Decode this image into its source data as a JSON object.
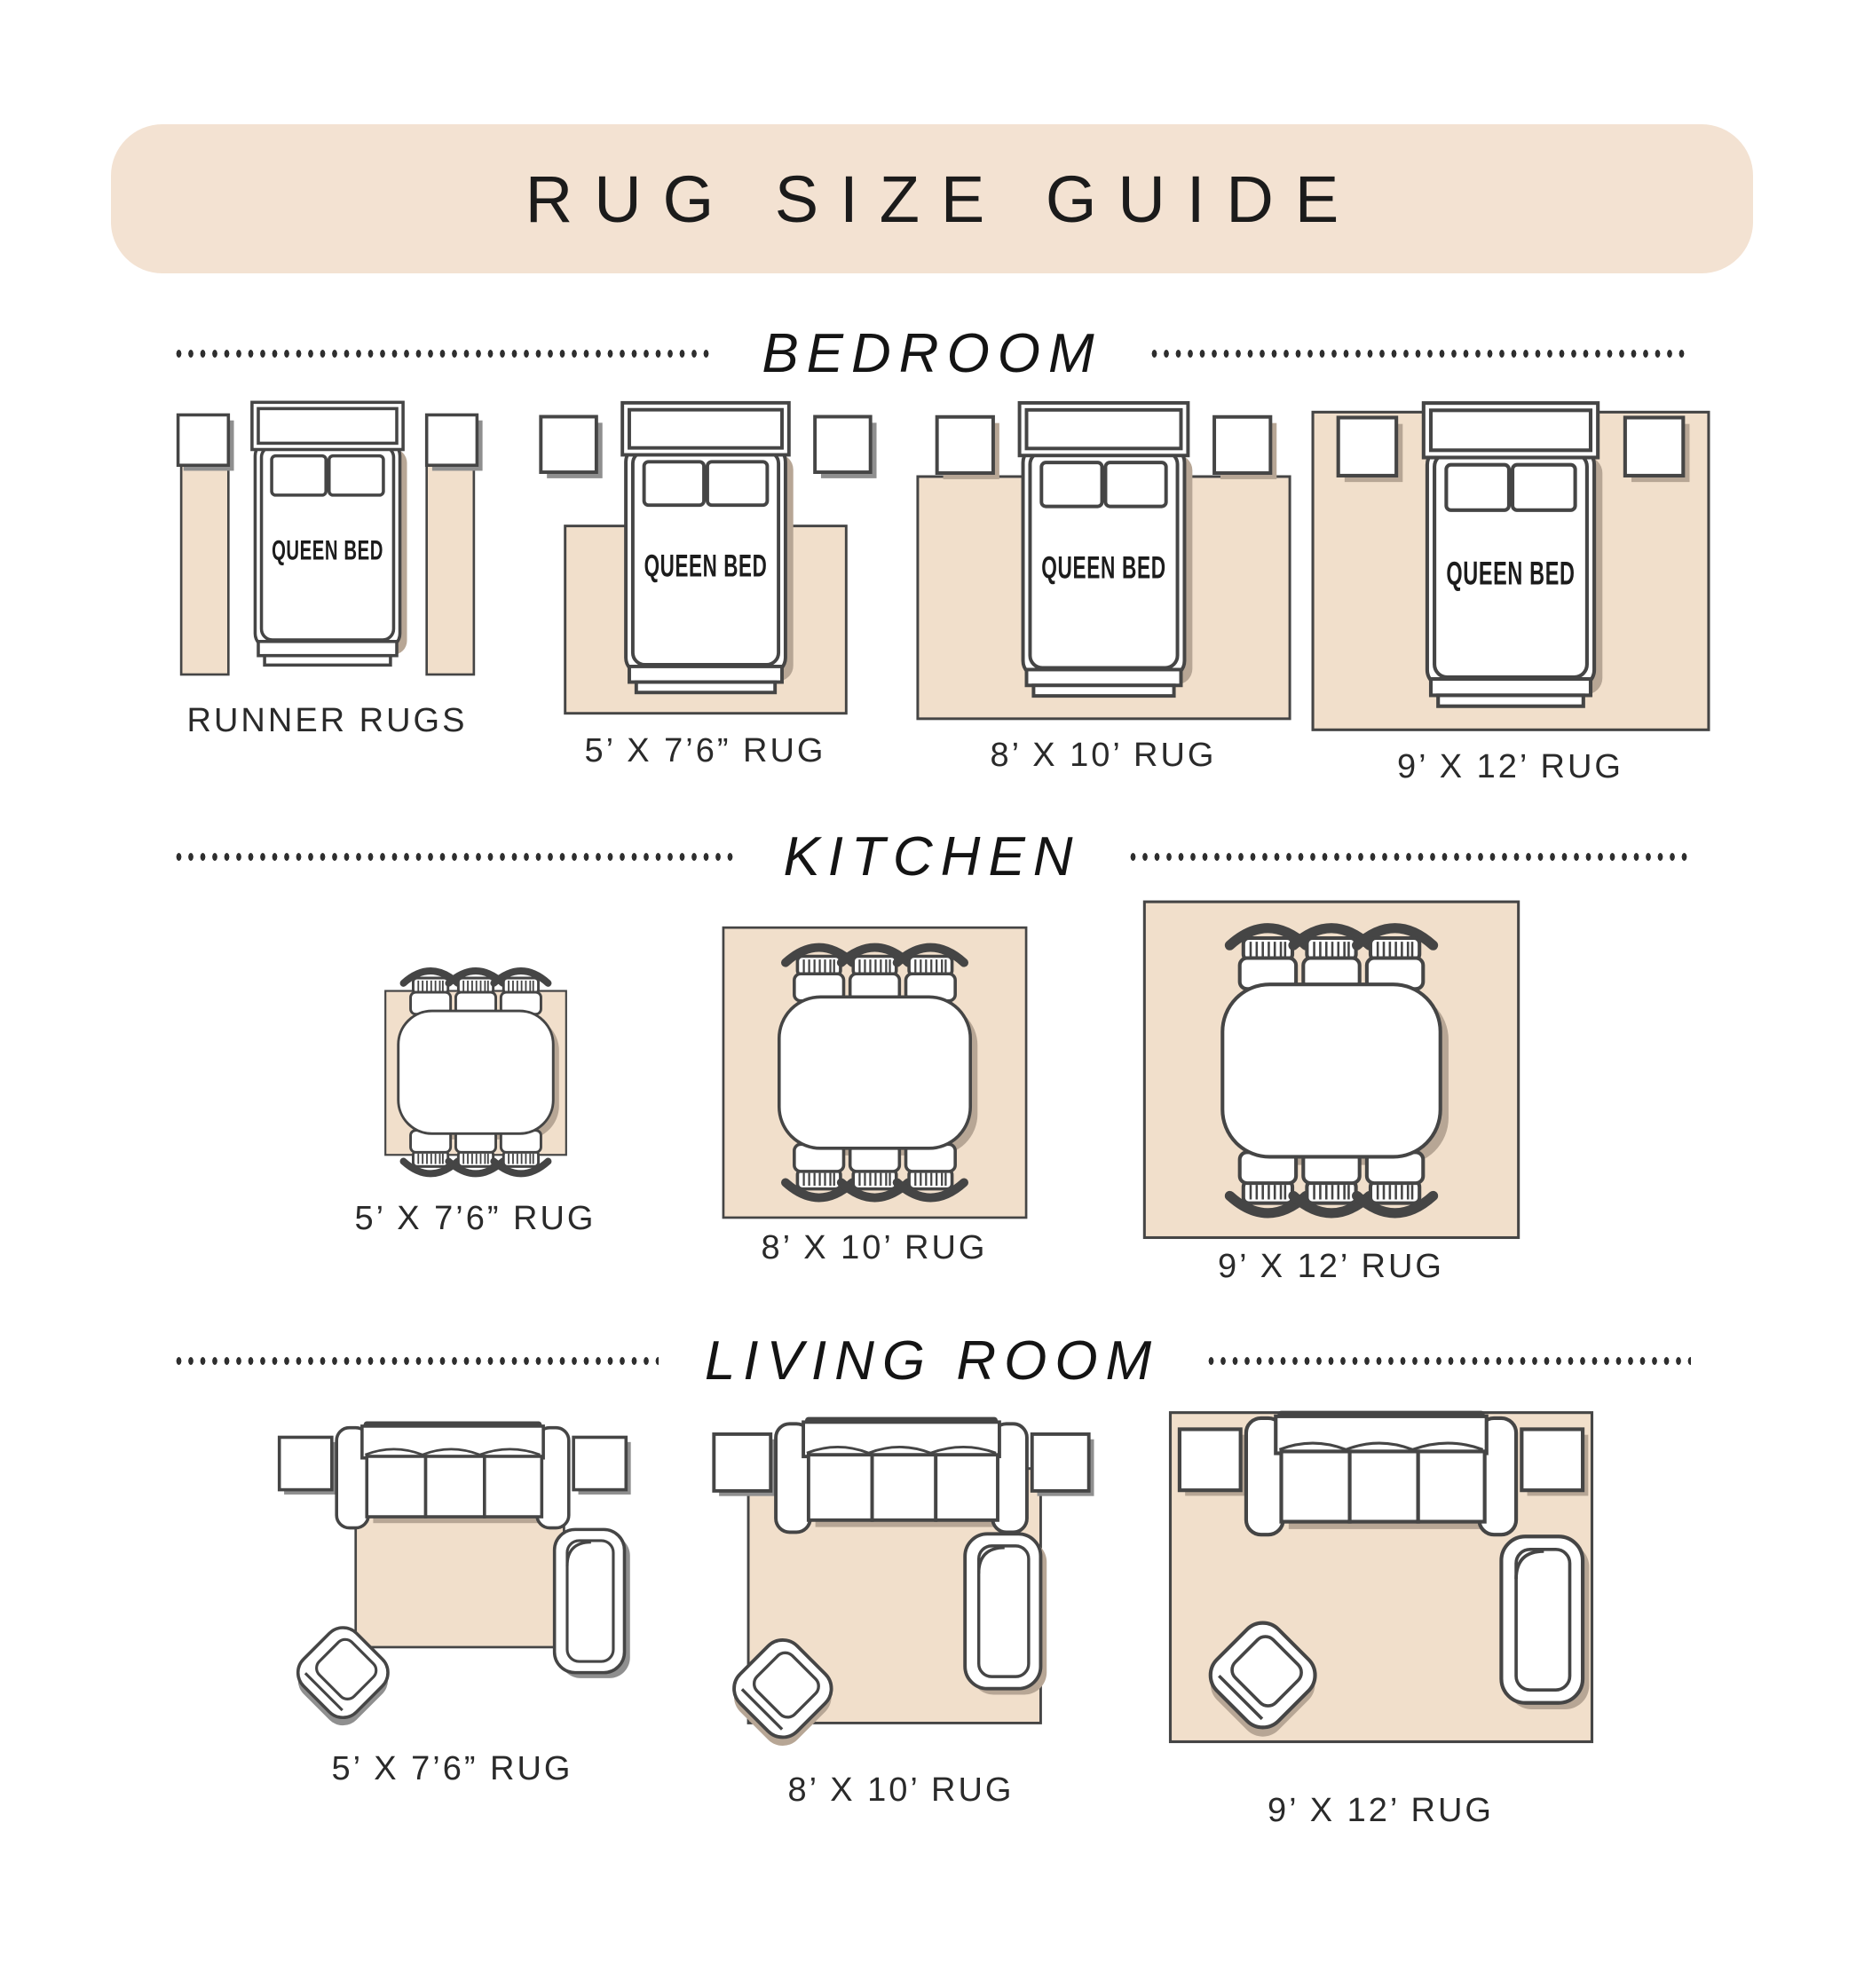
{
  "title": "RUG SIZE GUIDE",
  "colors": {
    "background": "#ffffff",
    "banner": "#f3e2d2",
    "rug": "#f1dfcb",
    "outline": "#454545",
    "shadow_on_rug": "#b7a695",
    "shadow_on_floor": "#8f8f8f",
    "text": "#1e1e1e",
    "dots": "#2e2e2e"
  },
  "sections": [
    {
      "id": "bedroom",
      "label": "BEDROOM",
      "figures": [
        {
          "caption": "RUNNER RUGS",
          "scene": "queen-bed-two-nightstands-two-runner-rugs",
          "furniture_label": "QUEEN BED"
        },
        {
          "caption": "5’ X 7’6” RUG",
          "scene": "queen-bed-two-nightstands-rug-under-lower-bed",
          "furniture_label": "QUEEN BED"
        },
        {
          "caption": "8’ X 10’ RUG",
          "scene": "queen-bed-two-nightstands-rug-to-nightstands",
          "furniture_label": "QUEEN BED"
        },
        {
          "caption": "9’ X 12’ RUG",
          "scene": "queen-bed-two-nightstands-all-on-rug",
          "furniture_label": "QUEEN BED"
        }
      ]
    },
    {
      "id": "kitchen",
      "label": "KITCHEN",
      "figures": [
        {
          "caption": "5’ X 7’6” RUG",
          "scene": "dining-table-six-chairs-small-rug"
        },
        {
          "caption": "8’ X 10’ RUG",
          "scene": "dining-table-six-chairs-medium-rug"
        },
        {
          "caption": "9’ X 12’ RUG",
          "scene": "dining-table-six-chairs-large-rug"
        }
      ]
    },
    {
      "id": "living-room",
      "label": "LIVING ROOM",
      "figures": [
        {
          "caption": "5’ X 7’6” RUG",
          "scene": "sofa-side-tables-armchair-accent-chair-small-rug"
        },
        {
          "caption": "8’ X 10’ RUG",
          "scene": "sofa-side-tables-armchair-accent-chair-medium-rug"
        },
        {
          "caption": "9’ X 12’ RUG",
          "scene": "sofa-side-tables-armchair-accent-chair-large-rug"
        }
      ]
    }
  ]
}
